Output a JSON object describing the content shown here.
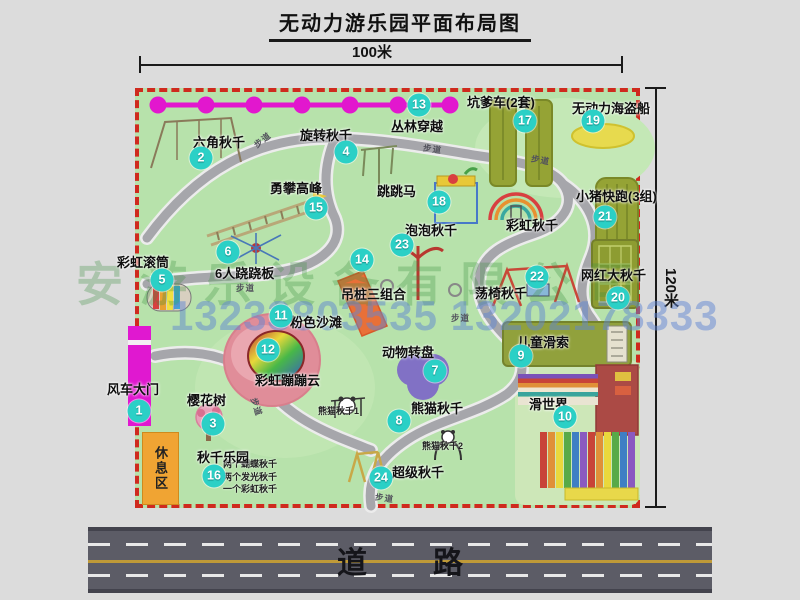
{
  "title": "无动力游乐园平面布局图",
  "dimensions": {
    "width": "100米",
    "height": "120米"
  },
  "road": {
    "label": "道路"
  },
  "rest_area": {
    "label": "休息区"
  },
  "watermarks": {
    "company": "安游乐设备有限公司",
    "phone": "13233803535 13202178333"
  },
  "map": {
    "attractions": [
      {
        "num": "1",
        "label": "风车大门",
        "lx": -28,
        "ly": 291,
        "bx": 4,
        "by": 323
      },
      {
        "num": "2",
        "label": "六角秋千",
        "lx": 58,
        "ly": 44,
        "bx": 66,
        "by": 70
      },
      {
        "num": "3",
        "label": "樱花树",
        "lx": 52,
        "ly": 302,
        "bx": 78,
        "by": 336
      },
      {
        "num": "4",
        "label": "旋转秋千",
        "lx": 165,
        "ly": 37,
        "bx": 211,
        "by": 64
      },
      {
        "num": "5",
        "label": "彩虹滚筒",
        "lx": -18,
        "ly": 164,
        "bx": 27,
        "by": 192
      },
      {
        "num": "6",
        "label": "6人跷跷板",
        "lx": 80,
        "ly": 175,
        "bx": 93,
        "by": 164
      },
      {
        "num": "7",
        "label": "动物转盘",
        "lx": 247,
        "ly": 254,
        "bx": 300,
        "by": 283
      },
      {
        "num": "8",
        "label": "熊猫秋千",
        "lx": 276,
        "ly": 310,
        "bx": 264,
        "by": 333
      },
      {
        "num": "9",
        "label": "儿童滑索",
        "lx": 382,
        "ly": 244,
        "bx": 386,
        "by": 268
      },
      {
        "num": "10",
        "label": "滑世界",
        "lx": 394,
        "ly": 306,
        "bx": 430,
        "by": 329
      },
      {
        "num": "11",
        "label": "粉色沙滩",
        "lx": 155,
        "ly": 224,
        "bx": 146,
        "by": 228
      },
      {
        "num": "12",
        "label": "彩虹蹦蹦云",
        "lx": 120,
        "ly": 282,
        "bx": 133,
        "by": 262
      },
      {
        "num": "13",
        "label": "丛林穿越",
        "lx": 256,
        "ly": 28,
        "bx": 284,
        "by": 17
      },
      {
        "num": "14",
        "label": "吊桩三组合",
        "lx": 206,
        "ly": 196,
        "bx": 227,
        "by": 172
      },
      {
        "num": "15",
        "label": "勇攀高峰",
        "lx": 135,
        "ly": 90,
        "bx": 181,
        "by": 120
      },
      {
        "num": "16",
        "label": "秋千乐园",
        "lx": 62,
        "ly": 359,
        "bx": 79,
        "by": 388
      },
      {
        "num": "17",
        "label": "坑爹车(2套)",
        "lx": 332,
        "ly": 4,
        "bx": 390,
        "by": 33
      },
      {
        "num": "18",
        "label": "跳跳马",
        "lx": 242,
        "ly": 93,
        "bx": 304,
        "by": 114
      },
      {
        "num": "19",
        "label": "无动力海盗船",
        "lx": 437,
        "ly": 10,
        "bx": 458,
        "by": 33
      },
      {
        "num": "20",
        "label": "网红大秋千",
        "lx": 446,
        "ly": 177,
        "bx": 483,
        "by": 210
      },
      {
        "num": "21",
        "label": "小猪快跑(3组)",
        "lx": 441,
        "ly": 98,
        "bx": 470,
        "by": 129
      },
      {
        "num": "22",
        "label": "荡椅秋千",
        "lx": 340,
        "ly": 195,
        "bx": 402,
        "by": 189
      },
      {
        "num": "23",
        "label": "泡泡秋千",
        "lx": 270,
        "ly": 132,
        "bx": 267,
        "by": 157
      },
      {
        "num": "24",
        "label": "超级秋千",
        "lx": 257,
        "ly": 374,
        "bx": 246,
        "by": 390
      }
    ],
    "extra_labels": [
      {
        "text": "彩虹秋千",
        "x": 371,
        "y": 127,
        "cls": "lbl"
      },
      {
        "text": "熊猫秋千1",
        "x": 183,
        "y": 316,
        "cls": "sub"
      },
      {
        "text": "熊猫秋千2",
        "x": 287,
        "y": 351,
        "cls": "sub"
      }
    ],
    "swing_park_notes": [
      "两个蝴蝶秋千",
      "两个发光秋千",
      "一个彩虹秋千"
    ],
    "path_label": "步道",
    "path_label_positions": [
      {
        "x": 118,
        "y": 46,
        "r": -38
      },
      {
        "x": 288,
        "y": 55,
        "r": 8
      },
      {
        "x": 396,
        "y": 66,
        "r": 10
      },
      {
        "x": 101,
        "y": 194,
        "r": 0
      },
      {
        "x": 112,
        "y": 313,
        "r": 72
      },
      {
        "x": 316,
        "y": 224,
        "r": 0
      },
      {
        "x": 240,
        "y": 404,
        "r": 8
      }
    ],
    "colors": {
      "park_green": "#b7e2ab",
      "border_red": "#cf2a1e",
      "badge": "#2bd0c6",
      "zipline_magenta": "#e217ce",
      "road_gray": "#5c5c66",
      "rest_orange": "#f0a433",
      "olive_equipment": "#95a335",
      "beach_pink": "#e08d99",
      "turntable_purple": "#8171c5",
      "pirate_yellow": "#e7da4e"
    }
  }
}
